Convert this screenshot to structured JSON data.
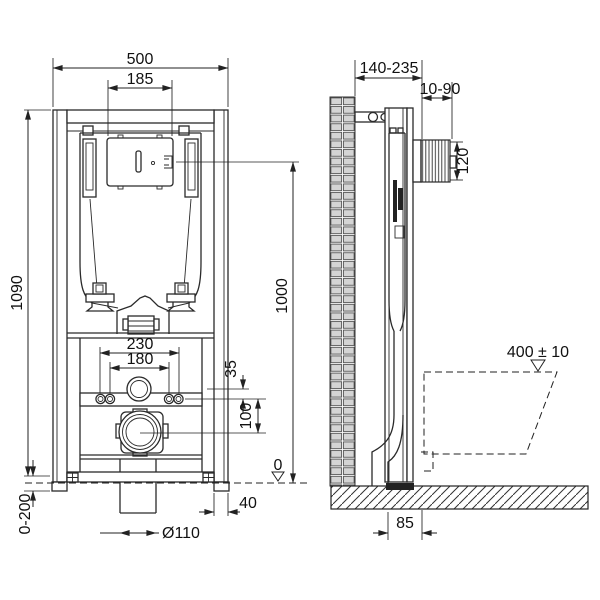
{
  "palette": {
    "line_color": "#2a2a2a",
    "background": "#ffffff",
    "brick_fill": "#d4d4d4",
    "foot_fill": "#222222"
  },
  "front_view": {
    "overall_width": "500",
    "flush_window_width": "185",
    "overall_height": "1090",
    "leg_adjustment": "0-200",
    "fixing_spacing_outer": "230",
    "fixing_spacing_inner": "180",
    "flush_pipe_offset": "35",
    "outlet_drop": "100",
    "foot_width": "40",
    "outlet_diameter": "Ø110",
    "datum_level": "0"
  },
  "side_view": {
    "frame_depth_range": "140-235",
    "finished_wall_range": "10-90",
    "flush_plate_height": "120",
    "actuation_height": "1000",
    "bowl_height": "400 ± 10",
    "outlet_wall_distance": "85"
  }
}
